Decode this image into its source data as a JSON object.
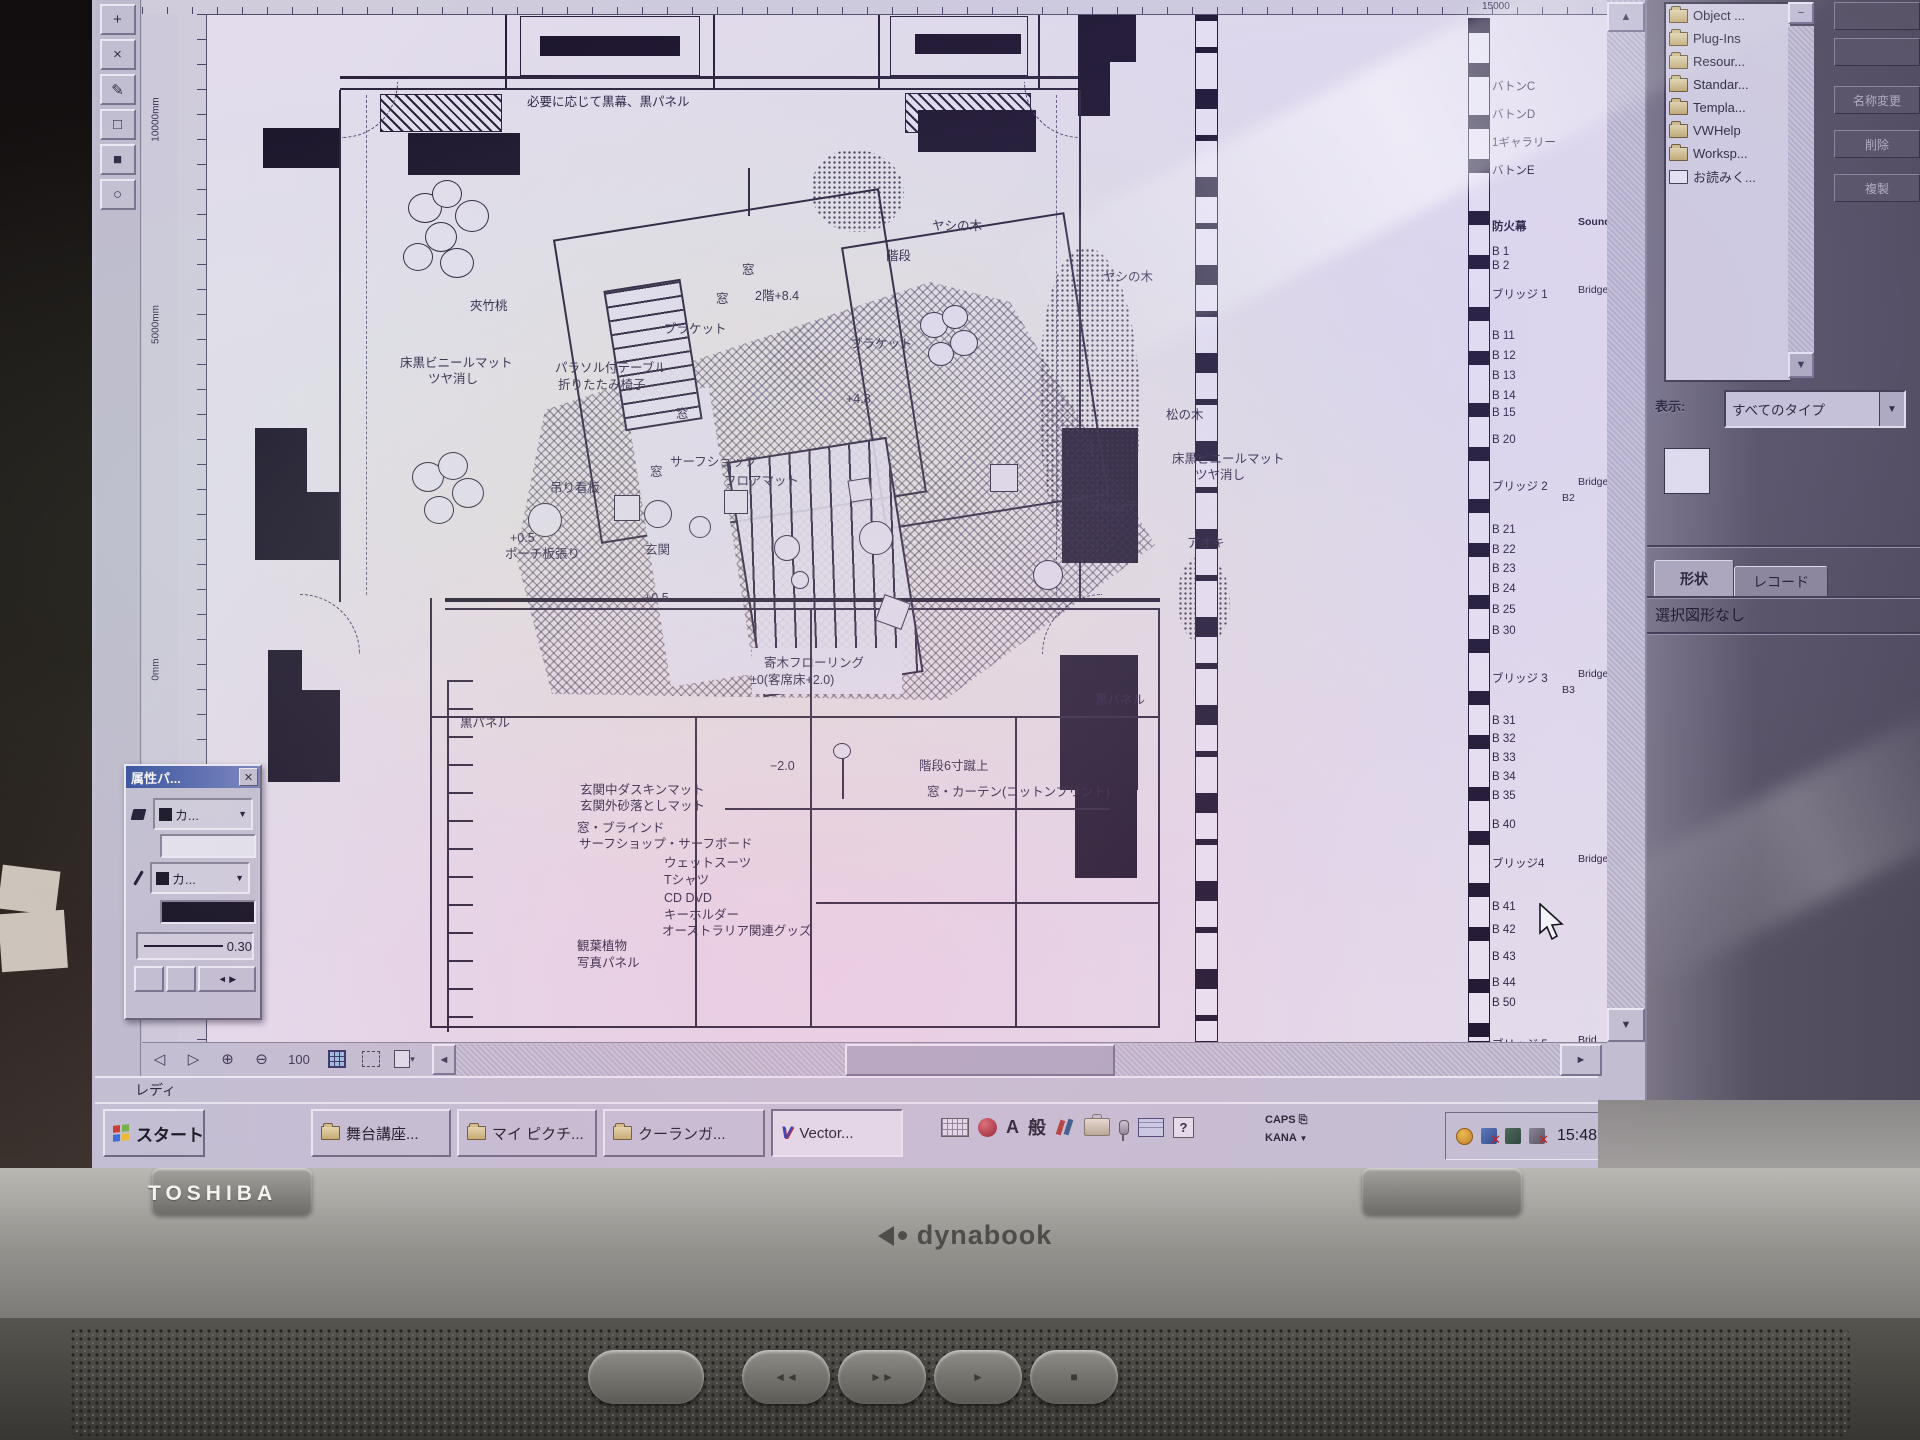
{
  "chrome": {
    "status_ready": "レディ",
    "ruler_top_label": "15000",
    "ruler_v_labels": [
      "10000mm",
      "5000mm",
      "0mm"
    ],
    "tools": [
      "+",
      "×",
      "✎",
      "□",
      "■",
      "○"
    ],
    "nav": {
      "prev": "◁",
      "next": "▷",
      "zoom_in": "⊕",
      "zoom_out": "⊖",
      "zoom_value": "100"
    },
    "scroll": {
      "up": "▲",
      "down": "▼",
      "left": "◄",
      "right": "►"
    }
  },
  "plan_labels": [
    {
      "t": "必要に応じて黒幕、黒パネル",
      "x": 527,
      "y": 96
    },
    {
      "t": "ヤシの木",
      "x": 932,
      "y": 220
    },
    {
      "t": "階段",
      "x": 886,
      "y": 250
    },
    {
      "t": "窓",
      "x": 742,
      "y": 264
    },
    {
      "t": "窓",
      "x": 716,
      "y": 293
    },
    {
      "t": "2階+8.4",
      "x": 755,
      "y": 290
    },
    {
      "t": "夾竹桃",
      "x": 470,
      "y": 300
    },
    {
      "t": "ブラケット",
      "x": 664,
      "y": 323
    },
    {
      "t": "ブラケット",
      "x": 850,
      "y": 338
    },
    {
      "t": "ヤシの木",
      "x": 1103,
      "y": 271
    },
    {
      "t": "床黒ビニールマット",
      "x": 400,
      "y": 357
    },
    {
      "t": "ツヤ消し",
      "x": 428,
      "y": 373
    },
    {
      "t": "パラソル付テーブル",
      "x": 555,
      "y": 362
    },
    {
      "t": "折りたたみ椅子",
      "x": 558,
      "y": 379
    },
    {
      "t": "+4.8",
      "x": 846,
      "y": 393
    },
    {
      "t": "窓",
      "x": 676,
      "y": 408
    },
    {
      "t": "松の木",
      "x": 1166,
      "y": 409
    },
    {
      "t": "冷",
      "x": 1083,
      "y": 442
    },
    {
      "t": "床黒ビニールマット",
      "x": 1172,
      "y": 453
    },
    {
      "t": "ツヤ消し",
      "x": 1195,
      "y": 469
    },
    {
      "t": "サーフショップ",
      "x": 670,
      "y": 456
    },
    {
      "t": "窓",
      "x": 650,
      "y": 466
    },
    {
      "t": "フロアマット",
      "x": 724,
      "y": 475
    },
    {
      "t": "吊り看板",
      "x": 550,
      "y": 482
    },
    {
      "t": "フレンチ",
      "x": 1089,
      "y": 500
    },
    {
      "t": "+0.5",
      "x": 510,
      "y": 532
    },
    {
      "t": "ポーチ板張り",
      "x": 505,
      "y": 548
    },
    {
      "t": "玄関",
      "x": 645,
      "y": 544
    },
    {
      "t": "アオキ",
      "x": 1187,
      "y": 537
    },
    {
      "t": "+0.5",
      "x": 644,
      "y": 592
    },
    {
      "t": "寄木フローリング",
      "x": 764,
      "y": 657
    },
    {
      "t": "±0(客席床+2.0)",
      "x": 750,
      "y": 674
    },
    {
      "t": "黒パネル",
      "x": 460,
      "y": 717
    },
    {
      "t": "黒パネル",
      "x": 1095,
      "y": 694
    },
    {
      "t": "−2.0",
      "x": 770,
      "y": 760
    },
    {
      "t": "階段6寸蹴上",
      "x": 919,
      "y": 760
    },
    {
      "t": "窓・カーテン(コットンプリント)",
      "x": 927,
      "y": 786
    },
    {
      "t": "玄関中ダスキンマット",
      "x": 580,
      "y": 784
    },
    {
      "t": "玄関外砂落としマット",
      "x": 580,
      "y": 800
    },
    {
      "t": "窓・ブラインド",
      "x": 577,
      "y": 822
    },
    {
      "t": "サーフショップ・サーフボード",
      "x": 579,
      "y": 838
    },
    {
      "t": "ウェットスーツ",
      "x": 664,
      "y": 857
    },
    {
      "t": "Tシャツ",
      "x": 664,
      "y": 874
    },
    {
      "t": "CD DVD",
      "x": 664,
      "y": 892
    },
    {
      "t": "キーホルダー",
      "x": 664,
      "y": 909
    },
    {
      "t": "オーストラリア関連グッズ",
      "x": 662,
      "y": 925
    },
    {
      "t": "観葉植物",
      "x": 577,
      "y": 940
    },
    {
      "t": "写真パネル",
      "x": 577,
      "y": 957
    }
  ],
  "battens": [
    {
      "t": "バトンC",
      "y": 78
    },
    {
      "t": "バトンD",
      "y": 106
    },
    {
      "t": "1ギャラリー",
      "y": 134
    },
    {
      "t": "バトンE",
      "y": 162
    },
    {
      "t": "防火幕",
      "y": 218,
      "en": "Sound",
      "cls": "bold"
    },
    {
      "t": "B 1",
      "y": 246
    },
    {
      "t": "B 2",
      "y": 260
    },
    {
      "t": "ブリッジ 1",
      "y": 286,
      "en": "Bridge"
    },
    {
      "t": "B 11",
      "y": 330
    },
    {
      "t": "B 12",
      "y": 350
    },
    {
      "t": "B 13",
      "y": 370
    },
    {
      "t": "B 14",
      "y": 390
    },
    {
      "t": "B 15",
      "y": 407
    },
    {
      "t": "B 20",
      "y": 434
    },
    {
      "t": "ブリッジ 2",
      "y": 478,
      "en": "Bridge"
    },
    {
      "t": "B2",
      "y": 492,
      "x": 1562,
      "cls": "sm"
    },
    {
      "t": "B 21",
      "y": 524
    },
    {
      "t": "B 22",
      "y": 544
    },
    {
      "t": "B 23",
      "y": 563
    },
    {
      "t": "B 24",
      "y": 583
    },
    {
      "t": "B 25",
      "y": 604
    },
    {
      "t": "B 30",
      "y": 625
    },
    {
      "t": "ブリッジ 3",
      "y": 670,
      "en": "Bridge"
    },
    {
      "t": "B3",
      "y": 684,
      "x": 1562,
      "cls": "sm"
    },
    {
      "t": "B 31",
      "y": 715
    },
    {
      "t": "B 32",
      "y": 733
    },
    {
      "t": "B 33",
      "y": 752
    },
    {
      "t": "B 34",
      "y": 771
    },
    {
      "t": "B 35",
      "y": 790
    },
    {
      "t": "B 40",
      "y": 819
    },
    {
      "t": "ブリッジ4",
      "y": 855,
      "en": "Bridge"
    },
    {
      "t": "B 41",
      "y": 901
    },
    {
      "t": "B 42",
      "y": 924
    },
    {
      "t": "B 43",
      "y": 951
    },
    {
      "t": "B 44",
      "y": 977
    },
    {
      "t": "B 50",
      "y": 997
    },
    {
      "t": "ブリッジ 5",
      "y": 1036,
      "en": "Brid"
    }
  ],
  "plan_shapes": [
    {
      "c": "so",
      "x": 505,
      "y": 4,
      "w": 210,
      "h": 86
    },
    {
      "c": "so1",
      "x": 520,
      "y": 16,
      "w": 180,
      "h": 60
    },
    {
      "c": "sb",
      "x": 552,
      "y": 0,
      "w": 118,
      "h": 12
    },
    {
      "c": "sb",
      "x": 540,
      "y": 36,
      "w": 140,
      "h": 20
    },
    {
      "c": "so",
      "x": 878,
      "y": 4,
      "w": 162,
      "h": 86
    },
    {
      "c": "so1",
      "x": 890,
      "y": 16,
      "w": 138,
      "h": 60
    },
    {
      "c": "sb",
      "x": 915,
      "y": 34,
      "w": 106,
      "h": 20
    },
    {
      "c": "sl",
      "x": 340,
      "y": 76,
      "w": 742,
      "h": 3
    },
    {
      "c": "sl",
      "x": 340,
      "y": 88,
      "w": 742,
      "h": 2
    },
    {
      "c": "sh",
      "x": 380,
      "y": 94,
      "w": 122,
      "h": 38
    },
    {
      "c": "sh",
      "x": 905,
      "y": 93,
      "w": 126,
      "h": 40
    },
    {
      "c": "sb",
      "x": 263,
      "y": 128,
      "w": 78,
      "h": 40
    },
    {
      "c": "sb",
      "x": 408,
      "y": 133,
      "w": 112,
      "h": 42
    },
    {
      "c": "sb",
      "x": 918,
      "y": 110,
      "w": 118,
      "h": 42
    },
    {
      "c": "sb",
      "x": 1078,
      "y": 0,
      "w": 58,
      "h": 62
    },
    {
      "c": "sb",
      "x": 1078,
      "y": 62,
      "w": 32,
      "h": 54
    },
    {
      "c": "sl",
      "x": 339,
      "y": 90,
      "w": 2,
      "h": 512
    },
    {
      "c": "sl",
      "x": 1079,
      "y": 90,
      "w": 2,
      "h": 512
    },
    {
      "c": "sd",
      "x": 366,
      "y": 95,
      "w": 1,
      "h": 500
    },
    {
      "c": "sd",
      "x": 1056,
      "y": 95,
      "w": 1,
      "h": 500
    },
    {
      "c": "arc a-tl",
      "x": 342,
      "y": 82,
      "w": 56,
      "h": 56
    },
    {
      "c": "arc a-tr",
      "x": 1024,
      "y": 82,
      "w": 56,
      "h": 56
    },
    {
      "c": "arc a-bl",
      "x": 300,
      "y": 594,
      "w": 60,
      "h": 60
    },
    {
      "c": "arc a-br",
      "x": 1042,
      "y": 594,
      "w": 60,
      "h": 60
    },
    {
      "c": "sb",
      "x": 255,
      "y": 428,
      "w": 52,
      "h": 132
    },
    {
      "c": "sb",
      "x": 285,
      "y": 492,
      "w": 54,
      "h": 68
    },
    {
      "c": "sb",
      "x": 1062,
      "y": 428,
      "w": 76,
      "h": 135
    },
    {
      "c": "sb",
      "x": 268,
      "y": 650,
      "w": 34,
      "h": 132
    },
    {
      "c": "sb",
      "x": 302,
      "y": 690,
      "w": 38,
      "h": 92
    },
    {
      "c": "sb",
      "x": 1060,
      "y": 655,
      "w": 78,
      "h": 135
    },
    {
      "c": "sb",
      "x": 1075,
      "y": 748,
      "w": 62,
      "h": 130
    },
    {
      "c": "herr",
      "x": 0,
      "y": 0,
      "w": 1600,
      "h": 1042
    },
    {
      "c": "so r9",
      "x": 575,
      "y": 212,
      "w": 330,
      "h": 308
    },
    {
      "c": "so r9",
      "x": 862,
      "y": 228,
      "w": 226,
      "h": 286
    },
    {
      "c": "wrect r9",
      "x": 648,
      "y": 392,
      "w": 84,
      "h": 290
    },
    {
      "c": "ladder r9",
      "x": 614,
      "y": 284,
      "w": 78,
      "h": 142
    },
    {
      "c": "stairs r9",
      "x": 744,
      "y": 448,
      "w": 162,
      "h": 238
    },
    {
      "c": "wrect",
      "x": 752,
      "y": 648,
      "w": 150,
      "h": 46
    },
    {
      "c": "sb",
      "x": 445,
      "y": 598,
      "w": 715,
      "h": 4
    },
    {
      "c": "sl",
      "x": 445,
      "y": 608,
      "w": 715,
      "h": 2
    },
    {
      "c": "sl",
      "x": 430,
      "y": 716,
      "w": 730,
      "h": 2
    },
    {
      "c": "sl",
      "x": 430,
      "y": 598,
      "w": 2,
      "h": 430
    },
    {
      "c": "sl",
      "x": 695,
      "y": 718,
      "w": 2,
      "h": 310
    },
    {
      "c": "sl",
      "x": 810,
      "y": 610,
      "w": 2,
      "h": 418
    },
    {
      "c": "sl",
      "x": 1015,
      "y": 718,
      "w": 2,
      "h": 310
    },
    {
      "c": "sl",
      "x": 1158,
      "y": 610,
      "w": 2,
      "h": 418
    },
    {
      "c": "sl",
      "x": 816,
      "y": 902,
      "w": 344,
      "h": 2
    },
    {
      "c": "sl",
      "x": 430,
      "y": 1026,
      "w": 730,
      "h": 2
    },
    {
      "c": "brk",
      "x": 447,
      "y": 680,
      "w": 26,
      "h": 352
    },
    {
      "c": "sl",
      "x": 725,
      "y": 808,
      "w": 385,
      "h": 2
    },
    {
      "c": "sl",
      "x": 748,
      "y": 168,
      "w": 2,
      "h": 48
    },
    {
      "c": "sl",
      "x": 842,
      "y": 753,
      "w": 2,
      "h": 46
    },
    {
      "c": "tree",
      "x": 833,
      "y": 743,
      "w": 18,
      "h": 16
    },
    {
      "c": "wsq",
      "x": 614,
      "y": 495,
      "w": 26,
      "h": 26
    },
    {
      "c": "wsq",
      "x": 724,
      "y": 490,
      "w": 24,
      "h": 24
    },
    {
      "c": "wsq",
      "x": 990,
      "y": 464,
      "w": 28,
      "h": 28
    },
    {
      "c": "wsq r20",
      "x": 879,
      "y": 598,
      "w": 28,
      "h": 28
    },
    {
      "c": "wsq r9",
      "x": 849,
      "y": 479,
      "w": 22,
      "h": 22
    },
    {
      "c": "wcir",
      "x": 528,
      "y": 503,
      "w": 34,
      "h": 34
    },
    {
      "c": "wcir",
      "x": 644,
      "y": 500,
      "w": 28,
      "h": 28
    },
    {
      "c": "wcir",
      "x": 689,
      "y": 516,
      "w": 22,
      "h": 22
    },
    {
      "c": "wcir",
      "x": 774,
      "y": 535,
      "w": 26,
      "h": 26
    },
    {
      "c": "wcir",
      "x": 859,
      "y": 521,
      "w": 34,
      "h": 34
    },
    {
      "c": "wcir",
      "x": 1033,
      "y": 560,
      "w": 30,
      "h": 30
    },
    {
      "c": "wcir",
      "x": 791,
      "y": 571,
      "w": 18,
      "h": 18
    },
    {
      "c": "tree",
      "x": 408,
      "y": 193,
      "w": 34,
      "h": 30
    },
    {
      "c": "tree",
      "x": 432,
      "y": 180,
      "w": 30,
      "h": 28
    },
    {
      "c": "tree",
      "x": 455,
      "y": 200,
      "w": 34,
      "h": 32
    },
    {
      "c": "tree",
      "x": 425,
      "y": 222,
      "w": 32,
      "h": 30
    },
    {
      "c": "tree",
      "x": 403,
      "y": 243,
      "w": 30,
      "h": 28
    },
    {
      "c": "tree",
      "x": 440,
      "y": 248,
      "w": 34,
      "h": 30
    },
    {
      "c": "tree",
      "x": 412,
      "y": 462,
      "w": 32,
      "h": 30
    },
    {
      "c": "tree",
      "x": 438,
      "y": 452,
      "w": 30,
      "h": 28
    },
    {
      "c": "tree",
      "x": 452,
      "y": 478,
      "w": 32,
      "h": 30
    },
    {
      "c": "tree",
      "x": 424,
      "y": 496,
      "w": 30,
      "h": 28
    },
    {
      "c": "tree",
      "x": 920,
      "y": 312,
      "w": 28,
      "h": 26
    },
    {
      "c": "tree",
      "x": 942,
      "y": 305,
      "w": 26,
      "h": 24
    },
    {
      "c": "tree",
      "x": 950,
      "y": 330,
      "w": 28,
      "h": 26
    },
    {
      "c": "tree",
      "x": 928,
      "y": 342,
      "w": 26,
      "h": 24
    },
    {
      "c": "dots",
      "x": 812,
      "y": 150,
      "w": 92,
      "h": 82
    },
    {
      "c": "dots",
      "x": 1040,
      "y": 248,
      "w": 100,
      "h": 315
    },
    {
      "c": "dots",
      "x": 1178,
      "y": 556,
      "w": 52,
      "h": 88
    },
    {
      "c": "bar1",
      "x": 1195,
      "y": 0,
      "w": 23,
      "h": 1042
    },
    {
      "c": "bar2",
      "x": 1468,
      "y": 18,
      "w": 22,
      "h": 1024
    }
  ],
  "object_browser": {
    "min_btn": "−",
    "items": [
      {
        "label": "Object ..."
      },
      {
        "label": "Plug-Ins"
      },
      {
        "label": "Resour..."
      },
      {
        "label": "Standar..."
      },
      {
        "label": "Templa..."
      },
      {
        "label": "VWHelp"
      },
      {
        "label": "Worksp..."
      },
      {
        "label": "お読みく...",
        "cls": "doc"
      }
    ],
    "buttons": [
      {
        "label": ""
      },
      {
        "label": ""
      },
      {
        "label": "名称変更"
      },
      {
        "label": "削除"
      },
      {
        "label": "複製"
      }
    ],
    "display_label": "表示:",
    "display_value": "すべてのタイプ"
  },
  "shape_panel": {
    "tab_shape": "形状",
    "tab_record": "レコード",
    "status": "選択図形なし"
  },
  "attr_palette": {
    "title": "属性パ...",
    "close": "✕",
    "fill_value": "カ...",
    "pen_value": "カ...",
    "line_weight": "0.30",
    "spin": "◄ ▶"
  },
  "taskbar": {
    "start": "スタート",
    "tasks": [
      {
        "label": "舞台講座...",
        "cls": "task"
      },
      {
        "label": "マイ ピクチ...",
        "cls": "task"
      },
      {
        "label": "クーランガ...",
        "cls": "task"
      },
      {
        "label": "Vector...",
        "cls": "task vw active"
      }
    ],
    "ime": {
      "a": "A",
      "gen": "般",
      "help": "?",
      "caps": "CAPS",
      "kana": "KANA",
      "kana_arrow": "▼"
    },
    "clock": "15:48"
  },
  "laptop": {
    "brand": "TOSHIBA",
    "model": "dynabook",
    "media": [
      "◄◄",
      "►►",
      "►",
      "■"
    ]
  }
}
